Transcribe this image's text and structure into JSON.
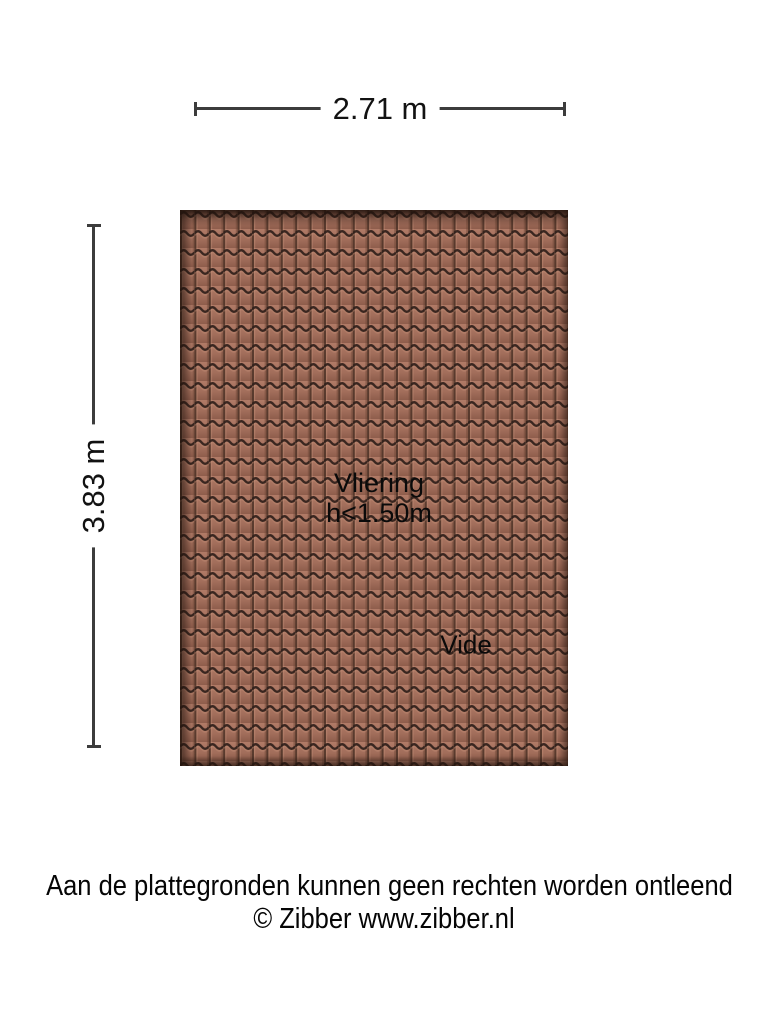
{
  "dimensions": {
    "width_label": "2.71 m",
    "height_label": "3.83 m"
  },
  "plan": {
    "room_label": "Vliering",
    "height_note": "h<1.50m",
    "vide_label": "Vide",
    "tile_body_color": "#a26e5b",
    "tile_line_color": "#30201a"
  },
  "footer": {
    "disclaimer": "Aan de plattegronden kunnen geen rechten worden ontleend",
    "copyright": "© Zibber www.zibber.nl"
  }
}
